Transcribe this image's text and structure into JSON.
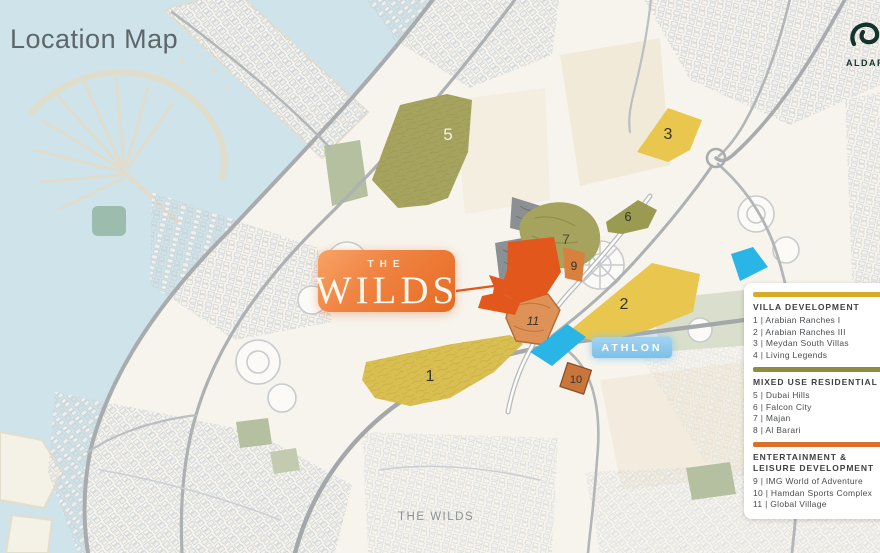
{
  "title": "Location Map",
  "logo": {
    "brand": "ALDAR"
  },
  "badge": {
    "line1": "THE",
    "line2": "WILDS"
  },
  "map_labels": {
    "athlon": "ATHLON",
    "bottom": "THE WILDS"
  },
  "regions": {
    "n1": "1",
    "n2": "2",
    "n3": "3",
    "n5": "5",
    "n6": "6",
    "n7": "7",
    "n9": "9",
    "n10": "10",
    "n11": "11"
  },
  "colors": {
    "gold": "#e9c74e",
    "gold_muted": "#d9be51",
    "olive": "#a5a35e",
    "olive_dark": "#9a9a51",
    "site_orange": "#e2571b",
    "orange_region": "#d8803e",
    "salmon": "#de9257",
    "terracotta": "#c8763c",
    "cyan": "#29b5e6",
    "gray_zone": "#8d9093",
    "legend_gold": "#d8aa28",
    "legend_olive": "#8f8c3f",
    "legend_orange": "#d9702c"
  },
  "legend": {
    "sections": [
      {
        "title": "VILLA DEVELOPMENT",
        "color": "#d8aa28",
        "items": [
          "1 | Arabian Ranches I",
          "2 | Arabian Ranches III",
          "3 | Meydan South Villas",
          "4 | Living Legends"
        ]
      },
      {
        "title": "MIXED USE RESIDENTIAL",
        "color": "#8f8c3f",
        "items": [
          "5 | Dubai Hills",
          "6 | Falcon City",
          "7 | Majan",
          "8 | Al Barari"
        ]
      },
      {
        "title": "ENTERTAINMENT & LEISURE DEVELOPMENT",
        "color": "#d9702c",
        "items": [
          "9 | IMG World of Adventure",
          "10 | Hamdan Sports Complex",
          "11 | Global Village"
        ]
      }
    ]
  }
}
